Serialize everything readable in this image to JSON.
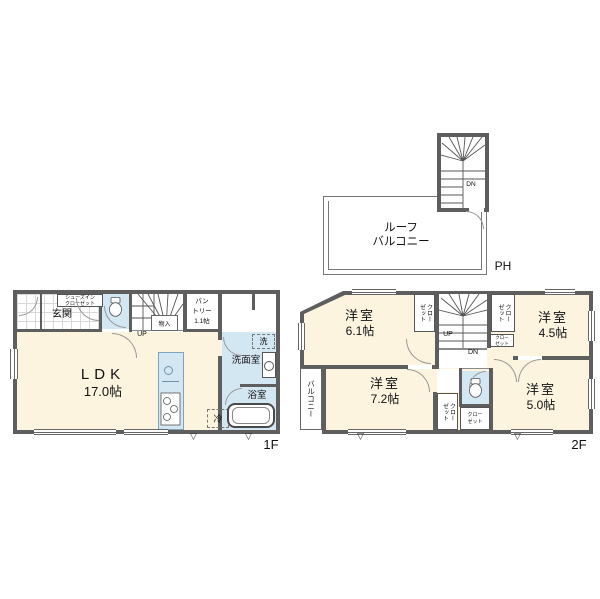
{
  "colors": {
    "wall": "#5e5e5e",
    "floor": "#fcf4df",
    "wet_area": "#d3e7f3",
    "line": "#777777"
  },
  "symbols": {
    "vent_triangle": "▽"
  },
  "roof": {
    "balcony_line1": "ルーフ",
    "balcony_line2": "バルコニー",
    "penthouse_label": "PH",
    "stairs_down": "DN"
  },
  "f1": {
    "floor_label": "1F",
    "entrance_label": "玄関",
    "shoes_closet_line1": "シューズイン",
    "shoes_closet_line2": "クローゼット",
    "stairs_up": "UP",
    "under_stairs_storage": "物入",
    "pantry_line1": "パン",
    "pantry_line2": "トリー",
    "pantry_size": "1.1帖",
    "ldk_name": "LDK",
    "ldk_size": "17.0帖",
    "washroom_label": "洗面室",
    "washer_label": "洗",
    "bathroom_label": "浴室",
    "fridge_label": "冷"
  },
  "f2": {
    "floor_label": "2F",
    "balcony_label": "バルコニー",
    "stairs_up": "UP",
    "stairs_down": "DN",
    "room_nw_name": "洋室",
    "room_nw_size": "6.1帖",
    "room_ne_name": "洋室",
    "room_ne_size": "4.5帖",
    "room_sw_name": "洋室",
    "room_sw_size": "7.2帖",
    "room_se_name": "洋室",
    "room_se_size": "5.0帖",
    "closet_vertical": "クローゼット",
    "closet_line1": "クロー",
    "closet_line2": "ゼット"
  }
}
